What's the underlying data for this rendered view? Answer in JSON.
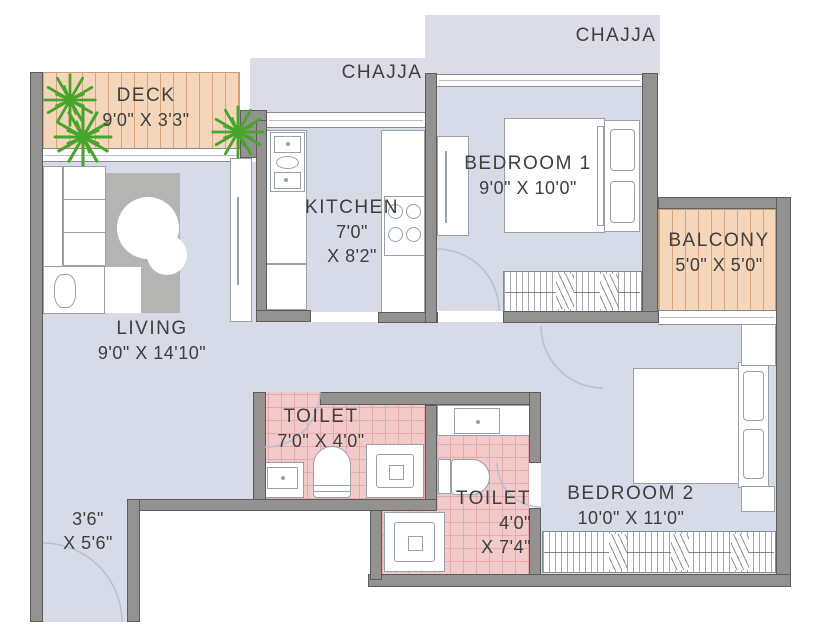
{
  "plan": {
    "chajja_bedroom": "CHAJJA",
    "chajja_kitchen": "CHAJJA",
    "deck": {
      "name": "DECK",
      "dims": "9'0\" X 3'3\""
    },
    "kitchen": {
      "name": "KITCHEN",
      "dims1": "7'0\"",
      "dims2": "X 8'2\""
    },
    "bedroom1": {
      "name": "BEDROOM 1",
      "dims": "9'0\" X 10'0\""
    },
    "balcony": {
      "name": "BALCONY",
      "dims": "5'0\" X 5'0\""
    },
    "living": {
      "name": "LIVING",
      "dims": "9'0\" X 14'10\""
    },
    "toilet1": {
      "name": "TOILET",
      "dims": "7'0\" X 4'0\""
    },
    "toilet2": {
      "name": "TOILET",
      "dims1": "4'0\"",
      "dims2": "X 7'4\""
    },
    "bedroom2": {
      "name": "BEDROOM 2",
      "dims": "10'0\" X 11'0\""
    },
    "entry": {
      "dims1": "3'6\"",
      "dims2": "X 5'6\""
    }
  },
  "colors": {
    "floor": "#d7dbe7",
    "chajja": "#dcdce9",
    "wall": "#949290",
    "wall_border": "#5c5c5a",
    "toilet_floor": "#f2caca",
    "toilet_grid": "rgba(219,152,152,0.6)",
    "deck_floor": "#f6d6ba",
    "deck_stripe": "rgba(186,115,66,0.5)",
    "rug": "#b4b4b2",
    "furniture_line": "#98a0aa",
    "plant": "#46a52c",
    "arc": "#b6c0d2",
    "text": "#3e3e3e"
  }
}
